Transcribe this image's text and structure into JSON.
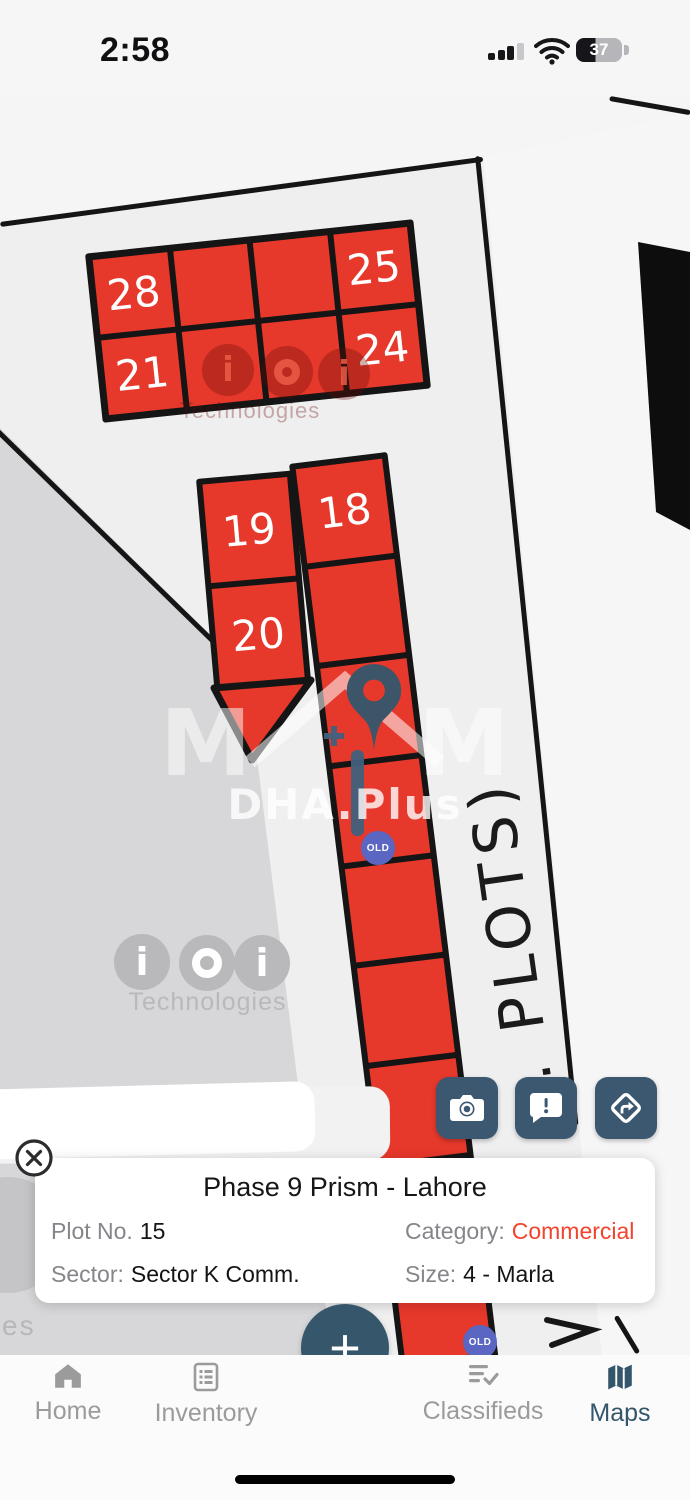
{
  "colors": {
    "plot_red": "#e6382b",
    "line_black": "#151515",
    "action_slate": "#3b5870",
    "fab_slate": "#35566b",
    "old_badge_blue": "#5a66c1",
    "category_red": "#f2432e",
    "nav_inactive_gray": "#9b9b9b",
    "nav_active_slate": "#33566b"
  },
  "status": {
    "time": "2:58",
    "battery": "37"
  },
  "map": {
    "road_label": ". PLOTS)",
    "old_label": "OLD",
    "blocks": {
      "top": [
        "28",
        "",
        "",
        "25",
        "21",
        "",
        "",
        "24"
      ],
      "colA": [
        "19",
        "20"
      ],
      "colB": [
        "18",
        "",
        "",
        "",
        "",
        "",
        "",
        "",
        ""
      ]
    },
    "watermark": {
      "brand": "DHA.Plus",
      "tech": "Technologies",
      "tail": "es",
      "i": "i",
      "m": "M"
    }
  },
  "card": {
    "title": "Phase 9 Prism - Lahore",
    "plot_no_label": "Plot No.",
    "plot_no_value": "15",
    "category_label": "Category:",
    "category_value": "Commercial",
    "sector_label": "Sector:",
    "sector_value": "Sector K Comm.",
    "size_label": "Size:",
    "size_value": "4 - Marla"
  },
  "fab": {
    "label": "+"
  },
  "nav": {
    "items": [
      {
        "label": "Home"
      },
      {
        "label": "Inventory"
      },
      {
        "label": "Classifieds"
      },
      {
        "label": "Maps"
      }
    ]
  }
}
